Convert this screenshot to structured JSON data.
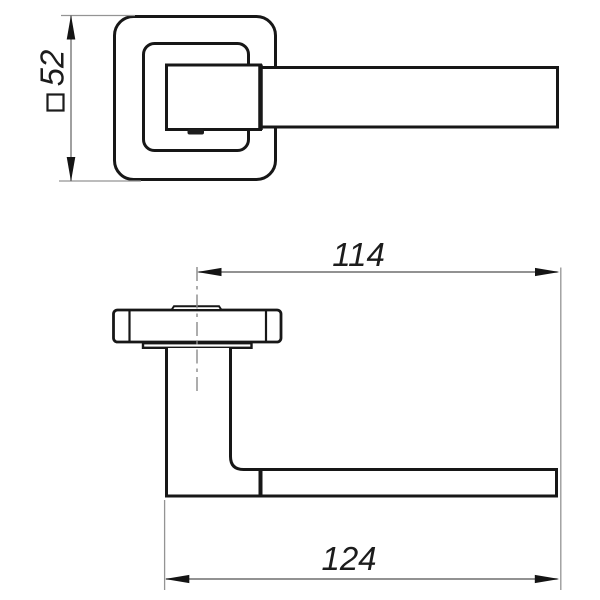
{
  "diagram": {
    "kind": "technical drawing - door lever handle on square rose, two orthographic views",
    "views": {
      "top": "front view of rose and lever",
      "bottom": "side profile view"
    },
    "dimensions": {
      "rose_square": {
        "symbol": "□",
        "value": "52"
      },
      "center_to_end": {
        "value": "114"
      },
      "overall_length": {
        "value": "124"
      }
    },
    "colors": {
      "outline": "#171717",
      "dimension_line": "#6f6f6f",
      "extension_line": "#949494",
      "arrow": "#141414",
      "label": "#1c1c1c",
      "background": "#ffffff"
    }
  }
}
